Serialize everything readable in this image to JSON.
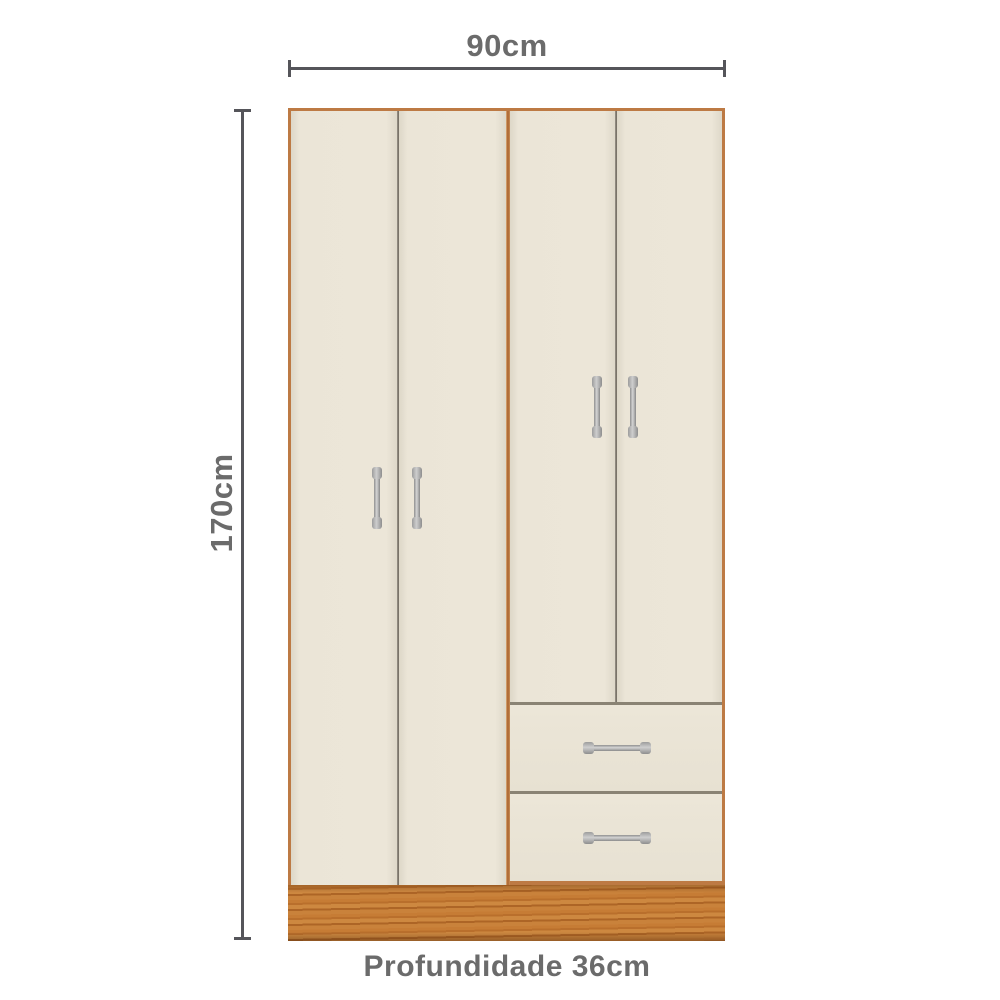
{
  "diagram": {
    "width_label": "90cm",
    "height_label": "170cm",
    "depth_label": "Profundidade 36cm"
  },
  "furniture": {
    "doors_count": 4,
    "drawers_count": 2
  },
  "colors": {
    "background": "#ffffff",
    "door_panel": "#eae4d6",
    "wood_frame": "#bd7a44",
    "wood_base": "#c0752e",
    "dimension_line": "#55555a",
    "label_text": "#6b6b6b",
    "handle_metal": "#c0c0c0"
  }
}
